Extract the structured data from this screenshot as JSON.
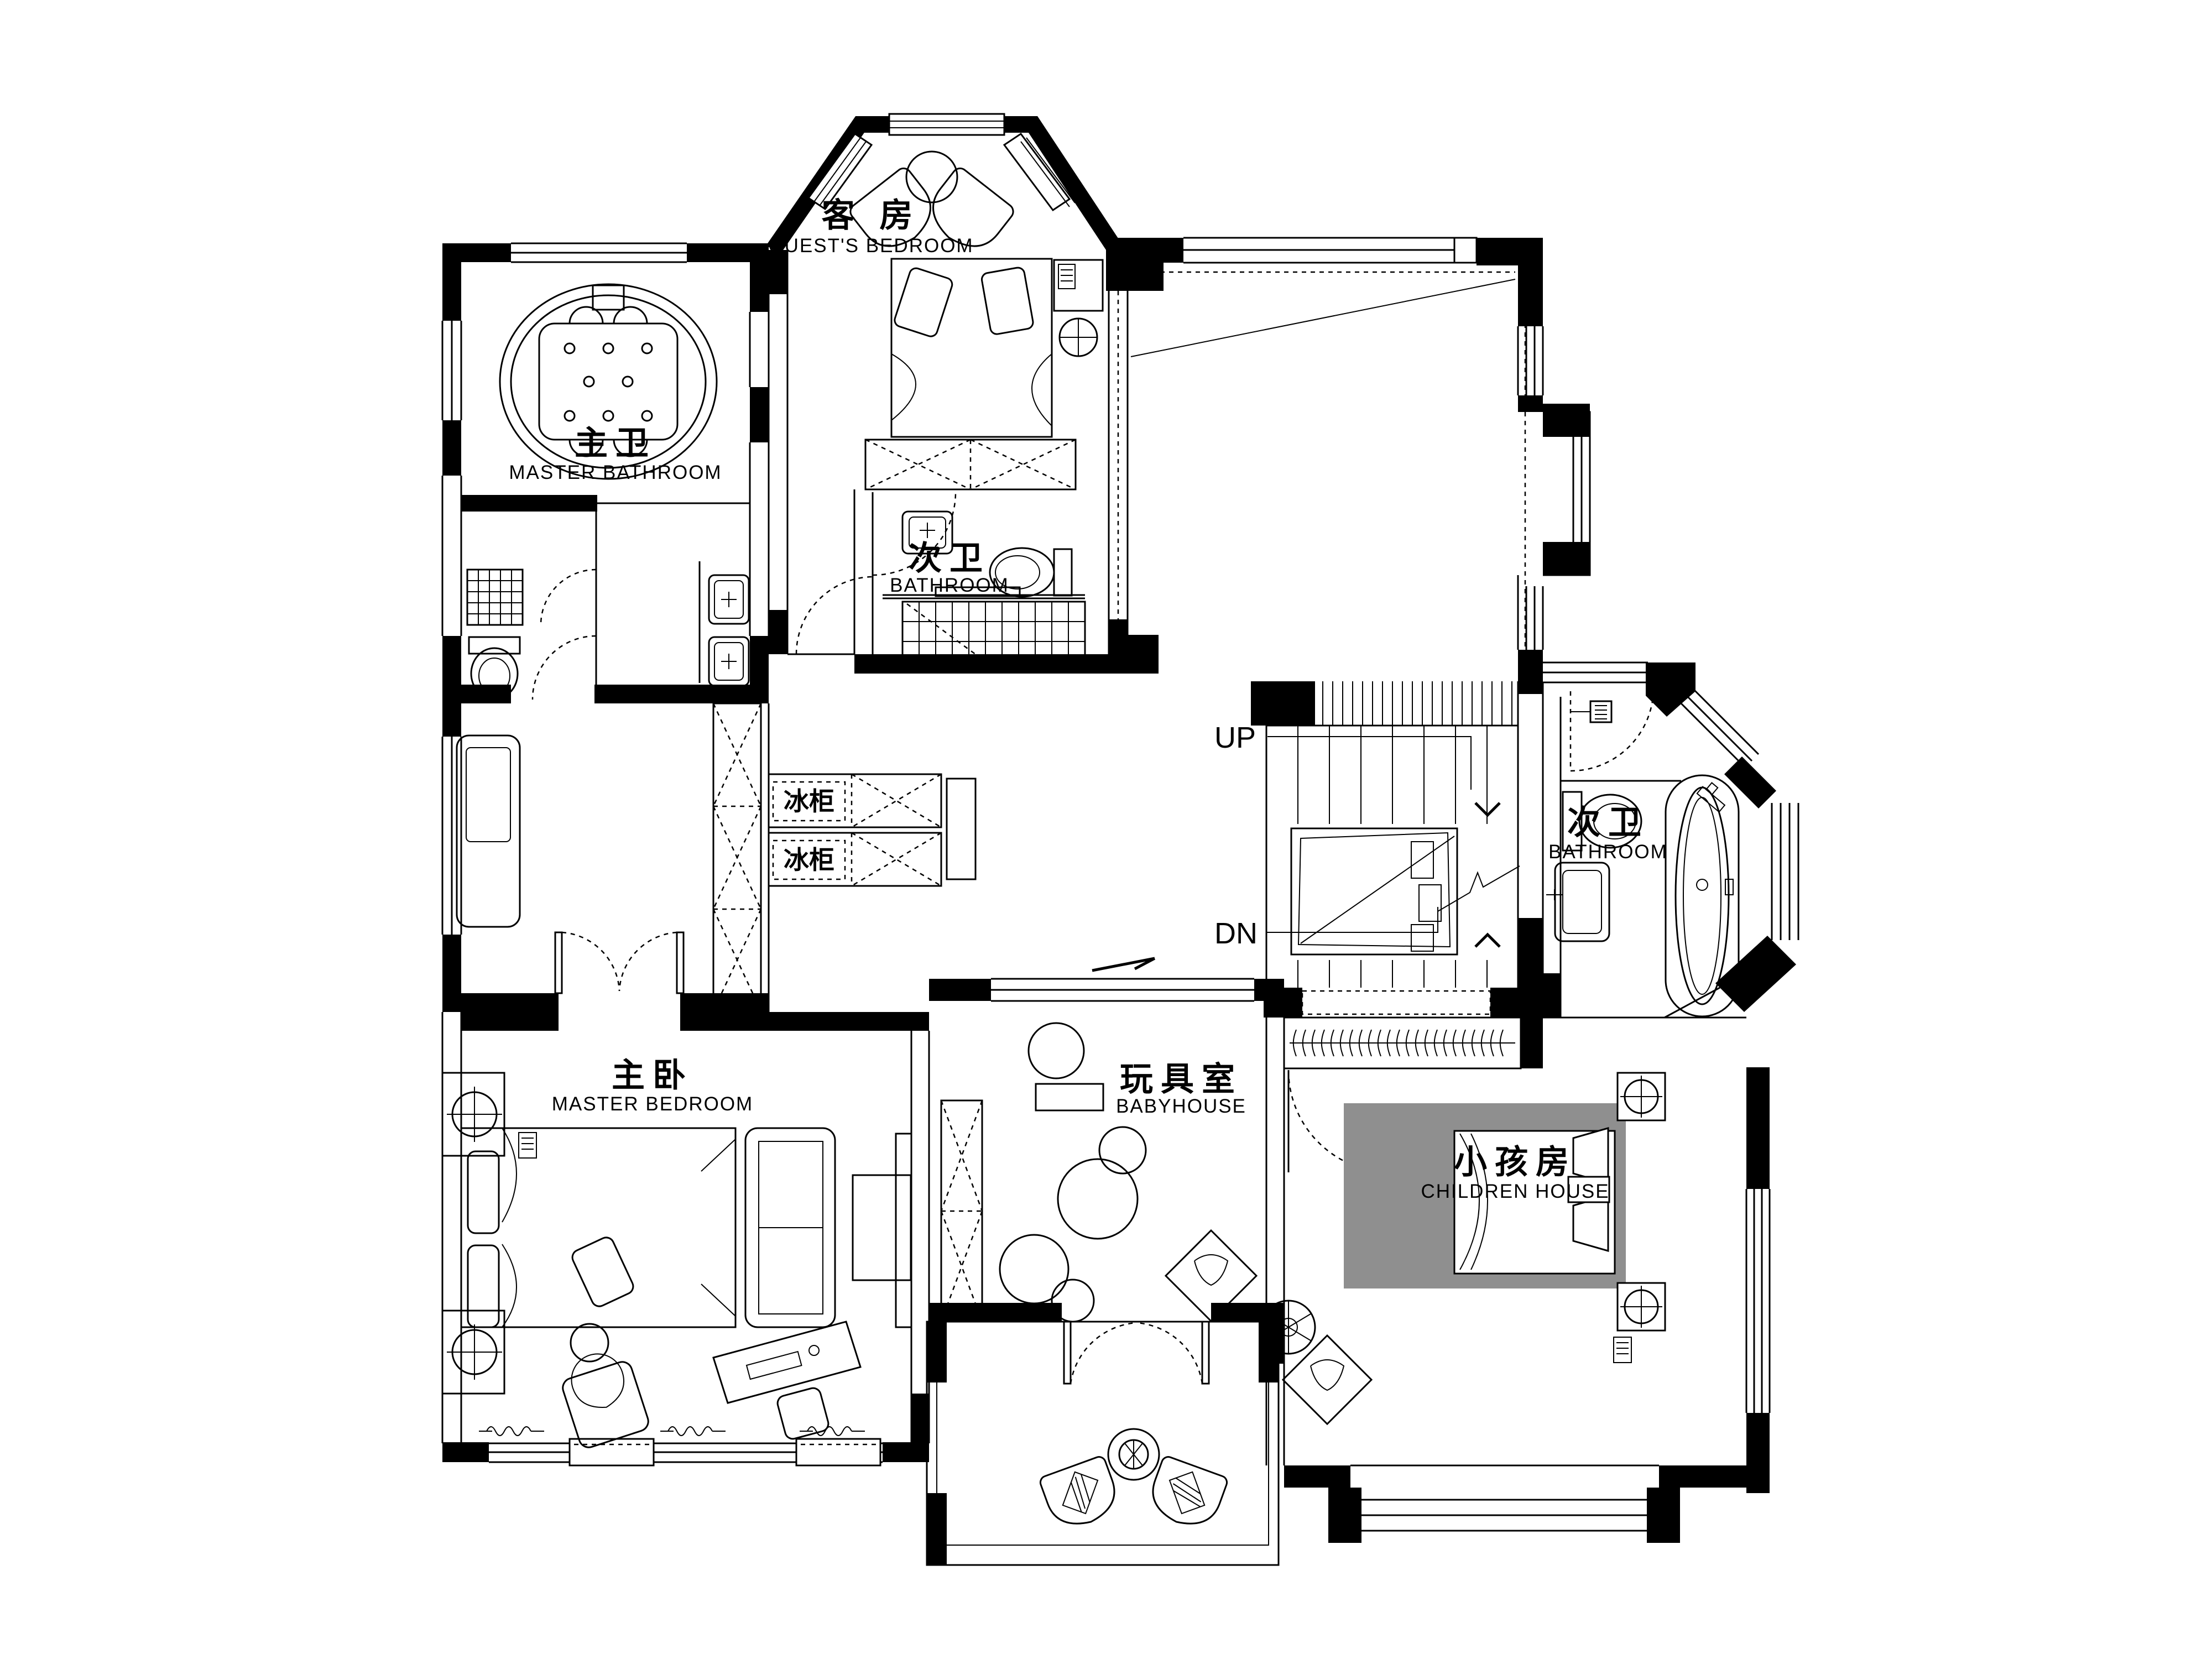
{
  "document": {
    "type": "residential floor plan (second floor)",
    "background_color": "#ffffff",
    "line_color": "#000000",
    "rug_color": "#8f8f8f"
  },
  "rooms": [
    {
      "id": "guest-bedroom",
      "name_zh": "客 房",
      "name_en": "GUEST'S BEDROOM"
    },
    {
      "id": "master-bathroom",
      "name_zh": "主卫",
      "name_en": "MASTER BATHROOM"
    },
    {
      "id": "bathroom-middle",
      "name_zh": "次卫",
      "name_en": "BATHROOM"
    },
    {
      "id": "bathroom-right",
      "name_zh": "次卫",
      "name_en": "BATHROOM"
    },
    {
      "id": "master-bedroom",
      "name_zh": "主卧",
      "name_en": "MASTER  BEDROOM"
    },
    {
      "id": "toy-room",
      "name_zh": "玩具室",
      "name_en": "BABYHOUSE"
    },
    {
      "id": "children-room",
      "name_zh": "小孩房",
      "name_en": "CHILDREN  HOUSE"
    }
  ],
  "annotations": {
    "freezer_top": "冰柜",
    "freezer_bottom": "冰柜",
    "stairs_up": "UP",
    "stairs_down": "DN"
  }
}
